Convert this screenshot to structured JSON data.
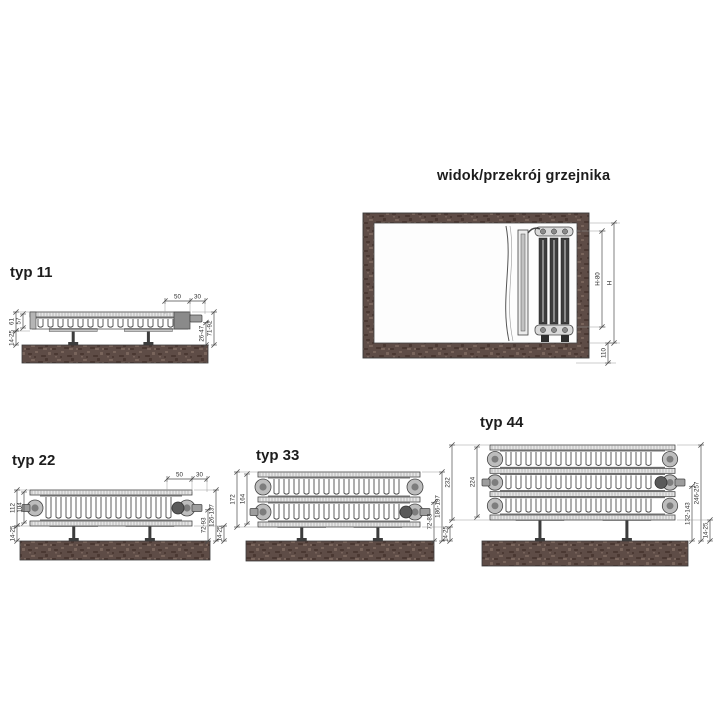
{
  "section_view": {
    "title": "widok/przekrój grzejnika",
    "dims": {
      "inner_height": "H-80",
      "total_height": "H",
      "bottom_clearance": "110"
    }
  },
  "types": [
    {
      "label": "typ 11",
      "top_dims": [
        "50",
        "30"
      ],
      "depth_total": "61",
      "depth_panel": "57",
      "wall_gap": "14-25",
      "bracket_range": "26-47",
      "front_range": "71-92"
    },
    {
      "label": "typ 22",
      "top_dims": [
        "50",
        "30"
      ],
      "depth_total": "112",
      "depth_panel": "104",
      "wall_gap": "14-25",
      "bracket_range": "72-93",
      "front_range": "126-137"
    },
    {
      "label": "typ 33",
      "depth_total": "172",
      "depth_panel": "164",
      "wall_gap": "14-25",
      "bracket_range": "72-83",
      "front_range": "186-197"
    },
    {
      "label": "typ 44",
      "depth_total": "232",
      "depth_panel": "224",
      "wall_gap": "14-25",
      "bracket_range": "132-143",
      "front_range": "246-257"
    }
  ],
  "colors": {
    "background": "#ffffff",
    "wall_base": "#5e4c46",
    "wall_dark": "#46352f",
    "wall_light": "#7e6a60",
    "line": "#454545",
    "panel_fill": "#e6e6e6",
    "metal_dark": "#3d3d3d",
    "text": "#1c1c1c"
  }
}
